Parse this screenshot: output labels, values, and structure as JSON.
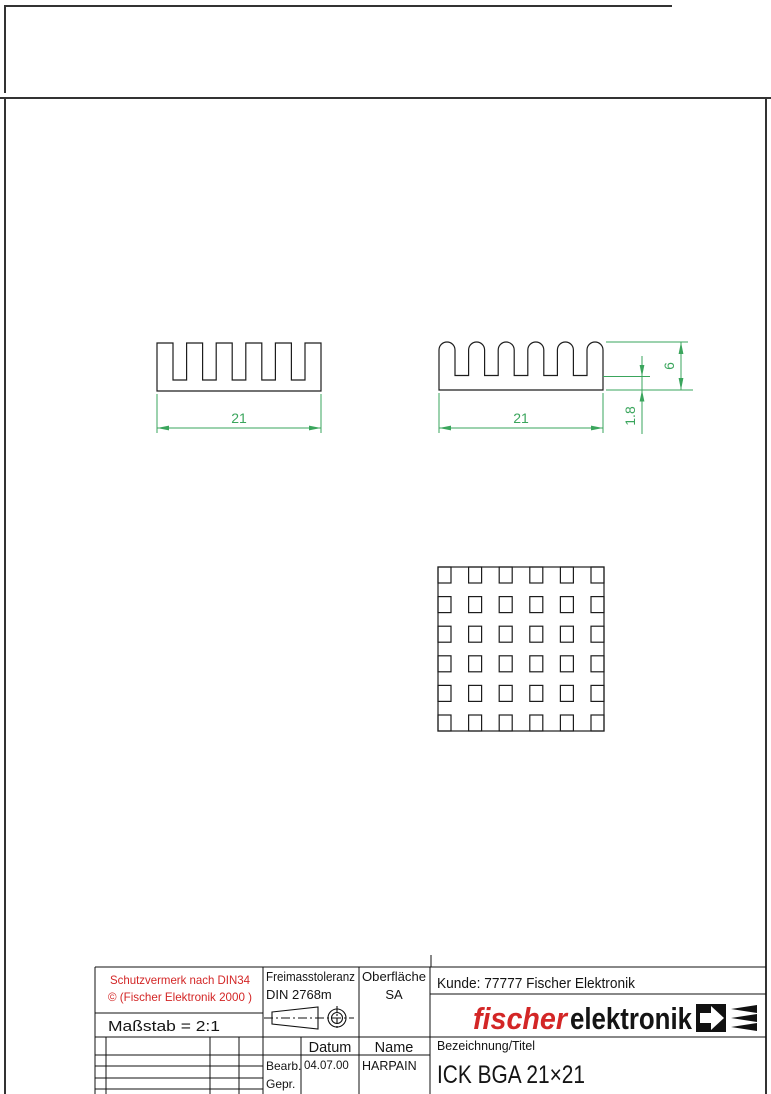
{
  "document": {
    "type": "technical-drawing",
    "colors": {
      "line": "#1d1d1d",
      "dimension_green": "#3aa55c",
      "brand_red": "#d32626"
    }
  },
  "views": {
    "front_view": {
      "name": "front-profile",
      "dim_width": "21"
    },
    "side_view": {
      "name": "side-profile",
      "dim_width": "21",
      "dim_height": "6",
      "dim_base": "1.8"
    },
    "bottom_view": {
      "name": "pin-grid",
      "rows": 6,
      "cols": 6
    }
  },
  "title_block": {
    "protection_note_line1": "Schutzvermerk nach DIN34",
    "protection_note_line2": "© (Fischer Elektronik 2000 )",
    "scale_label": "Maßstab = 2:1",
    "tolerance_label": "Freimasstoleranz",
    "tolerance_value": "DIN 2768m",
    "surface_label": "Oberfläche",
    "surface_value": "SA",
    "customer_line": "Kunde: 77777  Fischer Elektronik",
    "brand": {
      "part1": "fischer",
      "part2": "elektronik"
    },
    "date_header": "Datum",
    "name_header": "Name",
    "editor_label": "Bearb.",
    "editor_date": "04.07.00",
    "editor_name": "HARPAIN",
    "checked_label": "Gepr.",
    "designation_label": "Bezeichnung/Titel",
    "title": "ICK BGA 21×21"
  }
}
